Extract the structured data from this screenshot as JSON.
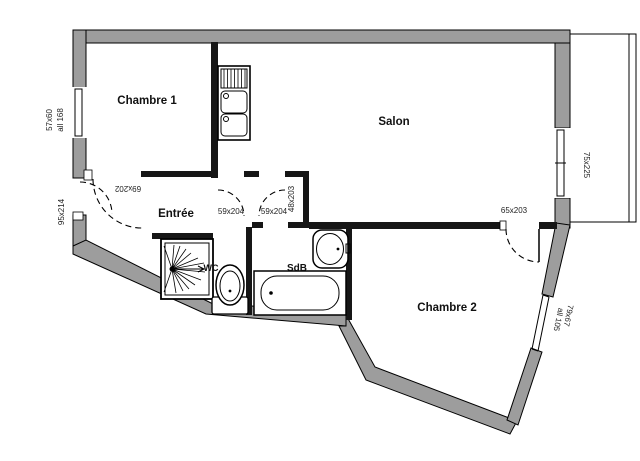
{
  "plan": {
    "rooms": [
      {
        "label": "Chambre 1"
      },
      {
        "label": "Salon"
      },
      {
        "label": "Entrée"
      },
      {
        "label": "SdB"
      },
      {
        "label": "WC"
      },
      {
        "label": "Chambre 2"
      }
    ],
    "openings": [
      {
        "label": "95x214"
      },
      {
        "label": "57x60",
        "sill": "all 168"
      },
      {
        "label": "69x202"
      },
      {
        "label": "59x204"
      },
      {
        "label": "59x204"
      },
      {
        "label": "48x203"
      },
      {
        "label": "65x203"
      },
      {
        "label": "75x225"
      },
      {
        "label": "79x67",
        "sill": "all 105"
      }
    ],
    "colors": {
      "wall": "#9d9d9d",
      "line": "#000000",
      "background": "#ffffff"
    },
    "fixtures": [
      "kitchen-sink",
      "shower",
      "toilet",
      "washbasin",
      "bathtub"
    ]
  }
}
